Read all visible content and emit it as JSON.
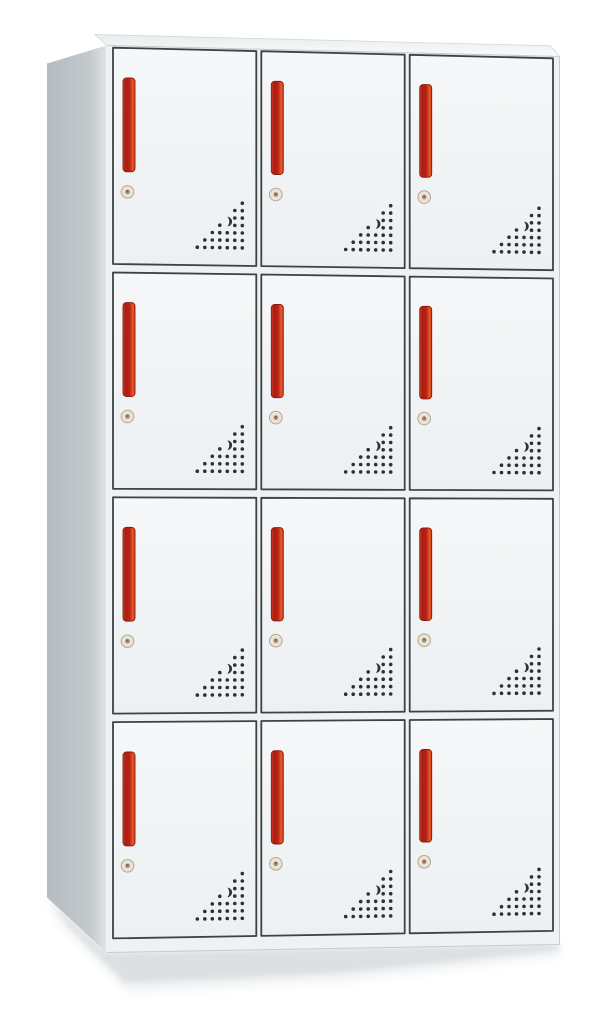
{
  "photo": {
    "subject": "12-door steel locker cabinet",
    "view": "three-quarter front-left product shot",
    "background": "#ffffff"
  },
  "cabinet": {
    "rows": 4,
    "columns": 3,
    "doors_total": 12,
    "door_features": [
      "vertical-red-handle",
      "round-cam-lock",
      "triangular-vent-hole-grid"
    ],
    "vent": {
      "pattern": "right-triangle dot grid, right-angle at bottom-right",
      "rows": 7,
      "spacing_px": 7.5,
      "crescent_slot": "curved slot replacing dots at column 3 from right, rows 3-4"
    }
  },
  "colors": {
    "background": "#ffffff",
    "face": "#eff1f3",
    "face_edge": "#c6cbce",
    "door_fill_top": "#f5f7f8",
    "door_fill_bottom": "#edf0f2",
    "door_outline": "#3d4245",
    "side_left": "#b5bcc0",
    "side_mid": "#c3c9cc",
    "side_edge": "#dde1e3",
    "top_back": "#e9edee",
    "top_front": "#f8fafb",
    "top_edge": "#d2d7d9",
    "handle_stops": [
      "#dd4a26",
      "#a81e15",
      "#b52317",
      "#ee5826",
      "#c23a1b"
    ],
    "handle_border": "#8c1a10",
    "lock_base": "#eae4d8",
    "lock_ring": "#b2a78f",
    "lock_pin": "#9c8c74",
    "lock_dot": "#b14a36",
    "vent_dot": "#2e3133",
    "shadow": "#d8dde0"
  }
}
